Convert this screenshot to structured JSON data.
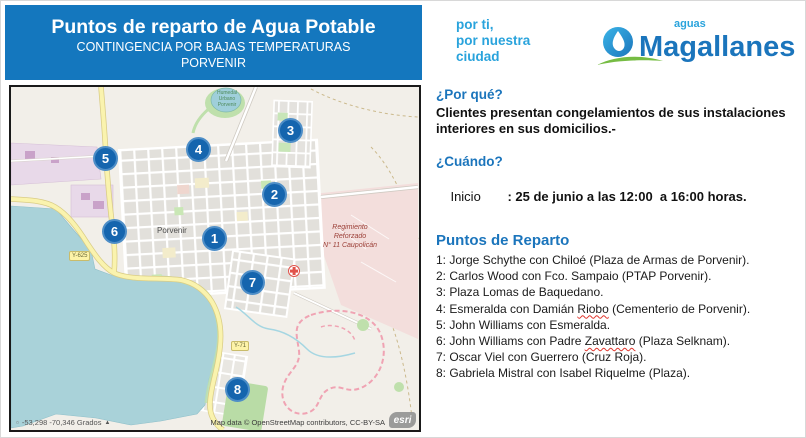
{
  "colors": {
    "header_blue": "#1477BE",
    "heading_blue": "#1B75BC",
    "slogan_cyan": "#29A3DC",
    "marker_blue": "#1565AE",
    "logo_green": "#76BC43",
    "map_water": "#A9D2D9",
    "regiment_pink": "#F3DEDC"
  },
  "header": {
    "title": "Puntos de reparto de Agua Potable",
    "subtitle1": "CONTINGENCIA POR BAJAS TEMPERATURAS",
    "subtitle2": "PORVENIR"
  },
  "brand": {
    "slogan_line1": "por ti,",
    "slogan_line2": "por nuestra",
    "slogan_line3": "ciudad",
    "logo_small": "aguas",
    "logo_name": "Magallanes"
  },
  "sections": {
    "why": {
      "heading": "¿Por qué?",
      "body_line1": "Clientes presentan congelamientos de sus instalaciones",
      "body_line2": "interiores en sus domicilios.-"
    },
    "when": {
      "heading": "¿Cuándo?",
      "label": "Inicio",
      "value": ": 25 de junio a las 12:00  a 16:00 horas."
    },
    "points": {
      "heading": "Puntos de Reparto",
      "items": [
        {
          "pre": "1: Jorge Schythe con Chiloé (Plaza de Armas de Porvenir).",
          "wavy": "",
          "post": ""
        },
        {
          "pre": "2: Carlos Wood con Fco. Sampaio (PTAP Porvenir).",
          "wavy": "",
          "post": ""
        },
        {
          "pre": "3: Plaza Lomas de Baquedano.",
          "wavy": "",
          "post": ""
        },
        {
          "pre": "4: Esmeralda con Damián ",
          "wavy": "Riobo",
          "post": " (Cementerio de Porvenir)."
        },
        {
          "pre": "5: John Williams con Esmeralda.",
          "wavy": "",
          "post": ""
        },
        {
          "pre": "6: John Williams con Padre ",
          "wavy": "Zavattaro",
          "post": " (Plaza Selknam)."
        },
        {
          "pre": "7: Oscar Viel con Guerrero (Cruz Roja).",
          "wavy": "",
          "post": ""
        },
        {
          "pre": "8: Gabriela Mistral con Isabel Riquelme (Plaza).",
          "wavy": "",
          "post": ""
        }
      ]
    }
  },
  "map": {
    "markers": [
      {
        "n": "1",
        "x": 204,
        "y": 152
      },
      {
        "n": "2",
        "x": 264,
        "y": 108
      },
      {
        "n": "3",
        "x": 280,
        "y": 44
      },
      {
        "n": "4",
        "x": 188,
        "y": 63
      },
      {
        "n": "5",
        "x": 95,
        "y": 72
      },
      {
        "n": "6",
        "x": 104,
        "y": 145
      },
      {
        "n": "7",
        "x": 242,
        "y": 196
      },
      {
        "n": "8",
        "x": 227,
        "y": 303
      }
    ],
    "labels": {
      "town": "Porvenir",
      "regiment": [
        "Regimiento",
        "Reforzado",
        "N° 11 Caupolicán"
      ],
      "wetland": [
        "Humedal",
        "Urbano",
        "Porvenir"
      ],
      "route_a": "Y-625",
      "route_b": "Y-71"
    },
    "attribution": "Map data © OpenStreetMap contributors, CC-BY-SA",
    "esri": "esri",
    "coordinates": "-53,298  -70,346 Grados"
  }
}
